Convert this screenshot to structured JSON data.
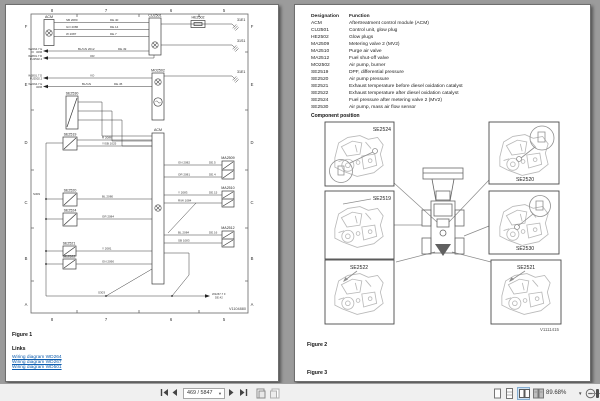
{
  "toolbar": {
    "page_indicator": "469 / 5847",
    "zoom_level": "89.68%",
    "icons": [
      "first-page",
      "previous-page",
      "next-page",
      "last-page",
      "previous-view",
      "next-view",
      "single-page-view",
      "continuous-view",
      "two-page-view",
      "two-page-continuous-view",
      "zoom-out",
      "zoom-slider"
    ]
  },
  "colors": {
    "link": "#0b5bad",
    "selected_view_highlight": "#cfe2f3",
    "viewer_background": "#9b9b9b"
  },
  "left_page": {
    "figure_label": "Figure 1",
    "links_heading": "Links",
    "links": [
      "Wiring diagram WD264",
      "Wiring diagram WD267",
      "Wiring diagram WD501"
    ],
    "diagram": {
      "ref": "V1104880",
      "grid_columns": [
        "8",
        "7",
        "6",
        "5"
      ],
      "grid_rows": [
        "F",
        "E",
        "D",
        "C",
        "B",
        "A"
      ],
      "components": {
        "acm_top": "ACM",
        "cu2501": "CU2501",
        "he2502": "HE2502",
        "mo2502": "MO2502",
        "se2530": "SE2530",
        "acm_center": "ACM",
        "se2519": "SE2519",
        "se2520": "SE2520",
        "se2524": "SE2524",
        "se2521": "SE2521",
        "se2522": "SE2522",
        "ma2509": "MA2509",
        "ma2510": "MA2510",
        "ma2512": "MA2512"
      },
      "grounds": [
        "31E1",
        "31S1",
        "31E1"
      ],
      "refs_out": [
        {
          "l1": "W2264.7 E",
          "l2": "3296"
        },
        {
          "l1": "W2801.7 D",
          "l2": "FU2502.2"
        },
        {
          "l1": "W2801.7 D",
          "l2": "FU2502.2"
        },
        {
          "l1": "W2264.7 E",
          "l2": "3296"
        },
        {
          "l1": "W2267.7 F",
          "l2": "DE.42"
        }
      ],
      "wire_labels": [
        "SB 2080",
        "DE.40",
        "GO 2086",
        "DE.14",
        "W 2087",
        "DE.7",
        "BL/GN 2012",
        "DE.49",
        "OR",
        "VO",
        "BL/GN",
        "DE.45",
        "R 2086",
        "Y/SB 1025",
        "BL 2080",
        "GR 2084",
        "Y 2081",
        "GN 2090",
        "GN 2082",
        "DE.5",
        "OR 2081",
        "DE.4",
        "Y 2083",
        "DE.15",
        "R/W 1084",
        "BL 2084",
        "DE.16",
        "SB 1083",
        "S309",
        "S303"
      ]
    }
  },
  "right_page": {
    "table": {
      "headers": [
        "Designation",
        "Function"
      ],
      "rows": [
        [
          "ACM",
          "Aftertreatment control module (ACM)"
        ],
        [
          "CU2501",
          "Control unit, glow plug"
        ],
        [
          "HE2502",
          "Glow plugs"
        ],
        [
          "MA2509",
          "Metering valve 2 (MV2)"
        ],
        [
          "MA2510",
          "Purge air valve"
        ],
        [
          "MA2512",
          "Fuel shut-off valve"
        ],
        [
          "MO2502",
          "Air pump, burner"
        ],
        [
          "SE2519",
          "DPF, differential pressure"
        ],
        [
          "SE2520",
          "Air pump pressure"
        ],
        [
          "SE2521",
          "Exhaust temperature before diesel oxidation catalyst"
        ],
        [
          "SE2522",
          "Exhaust temperature after diesel oxidation catalyst"
        ],
        [
          "SE2524",
          "Fuel pressure after metering valve 2 (MV2)"
        ],
        [
          "SE2530",
          "Air pump, mass air flow sensor"
        ]
      ]
    },
    "component_position_heading": "Component position",
    "figure2": {
      "boxes": [
        "SE2524",
        "SE2519",
        "SE2522",
        "SE2520",
        "SE2530",
        "SE2521"
      ],
      "ref": "V1111415"
    },
    "figure2_label": "Figure 2",
    "figure3_label": "Figure 3"
  }
}
